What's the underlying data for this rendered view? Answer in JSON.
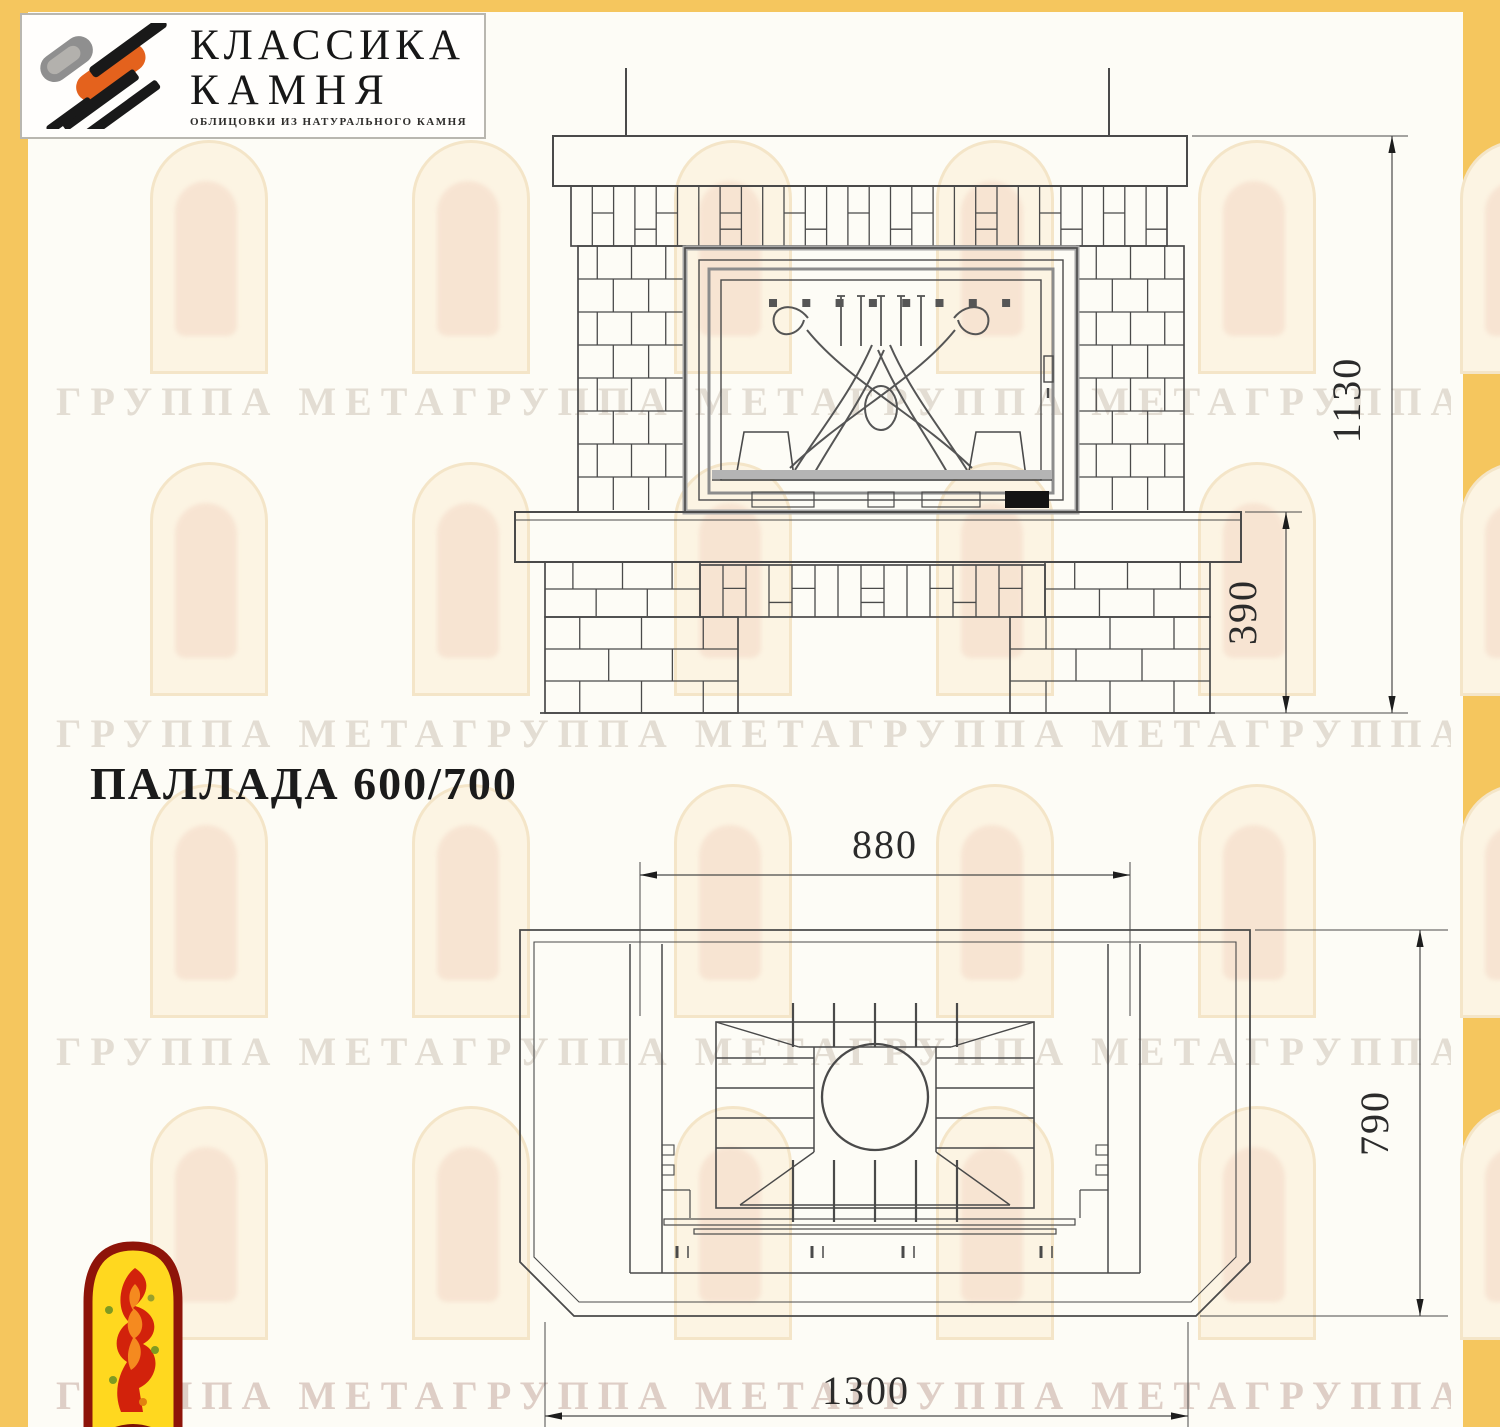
{
  "brand": {
    "name_line1": "КЛАССИКА",
    "name_line2": "КАМНЯ",
    "tagline": "ОБЛИЦОВКИ ИЗ НАТУРАЛЬНОГО КАМНЯ"
  },
  "title": "ПАЛЛАДА 600/700",
  "watermark": {
    "text": "ГРУППА МЕТАГРУППА МЕТАГРУППА МЕТАГРУППА МЕТА"
  },
  "drawing": {
    "front_view": {
      "name": "fireplace front elevation",
      "dims": {
        "height": "1130",
        "plinth_height": "390"
      }
    },
    "plan_view": {
      "name": "fireplace top plan",
      "dims": {
        "firebox_width": "880",
        "depth": "790",
        "overall_width": "1300"
      }
    }
  },
  "colors": {
    "frame_yellow": "#f5c65e",
    "paper": "#fdfcf6",
    "line": "#4a4a4a",
    "logo_orange": "#e4621d",
    "logo_gray": "#8f8f8f",
    "meta_red": "#8e1409",
    "meta_yellow": "#ffd81f"
  }
}
